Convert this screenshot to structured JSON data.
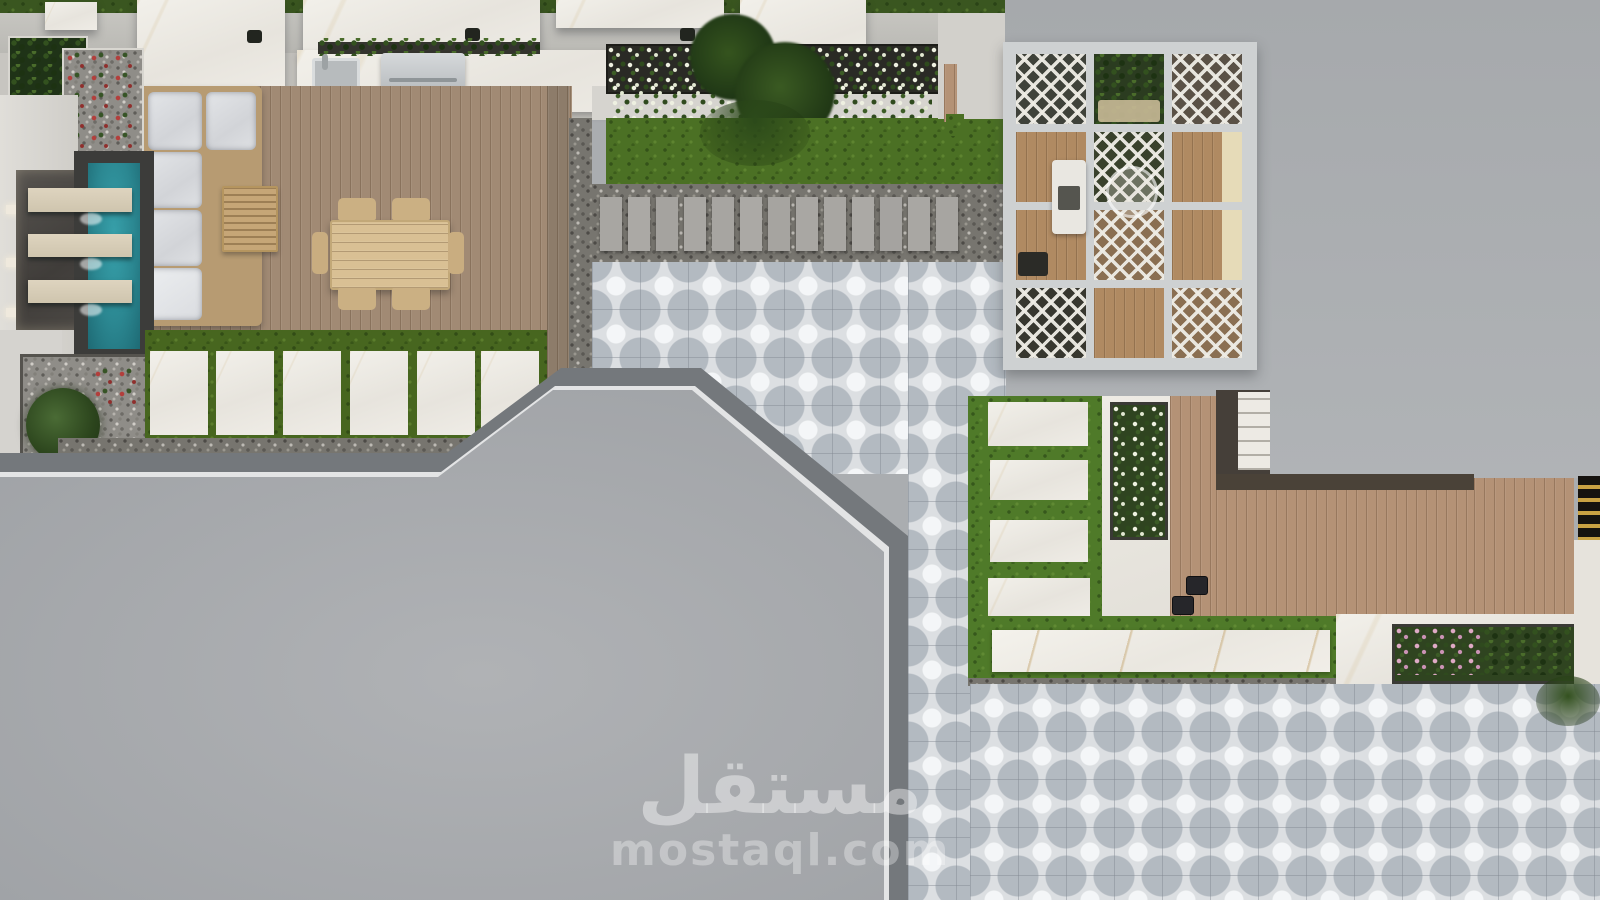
{
  "watermark": {
    "arabic": "مستقل",
    "latin": "mostaql.com"
  },
  "palette": {
    "grass_dark": "#3a5620",
    "lawn": "#4b7024",
    "grass_right": "#4f7a29",
    "concrete": "#aaadb0",
    "concrete_dark": "#74787c",
    "roof": "#a2a5a9",
    "marble": "#edeae3",
    "walkway": "#d5d3ce",
    "wall": "#c0bfba",
    "wood_gray": "#a18a74",
    "wood_warm": "#b49276",
    "wood_pergola": "#b08a62",
    "tile_base": "#dcdfe2",
    "tile_petal": "#b3bac1",
    "gravel": "#8f8d88",
    "gravel_dark": "#77756f",
    "pool": "#2b8791",
    "pool_deep": "#1e6a74",
    "pool_surround": "#3c3c3a",
    "planter_dark": "#2a2a25",
    "foliage": "#2c4a1d",
    "foliage_dark": "#1f3317",
    "flower_white": "#edefe0",
    "flower_pink": "#d9a6c2",
    "flower_red": "#b23f3c",
    "cushion": "#dcdee1",
    "beige": "#e6dbb8",
    "frame_tan": "#b79b72",
    "stone": "#a8a6a2",
    "steel": "#c6cacc",
    "dark_fixture": "#26262a",
    "stripe_yellow": "#c9a243",
    "stripe_black": "#16130f",
    "watermark": "rgba(255,255,255,0.42)"
  }
}
